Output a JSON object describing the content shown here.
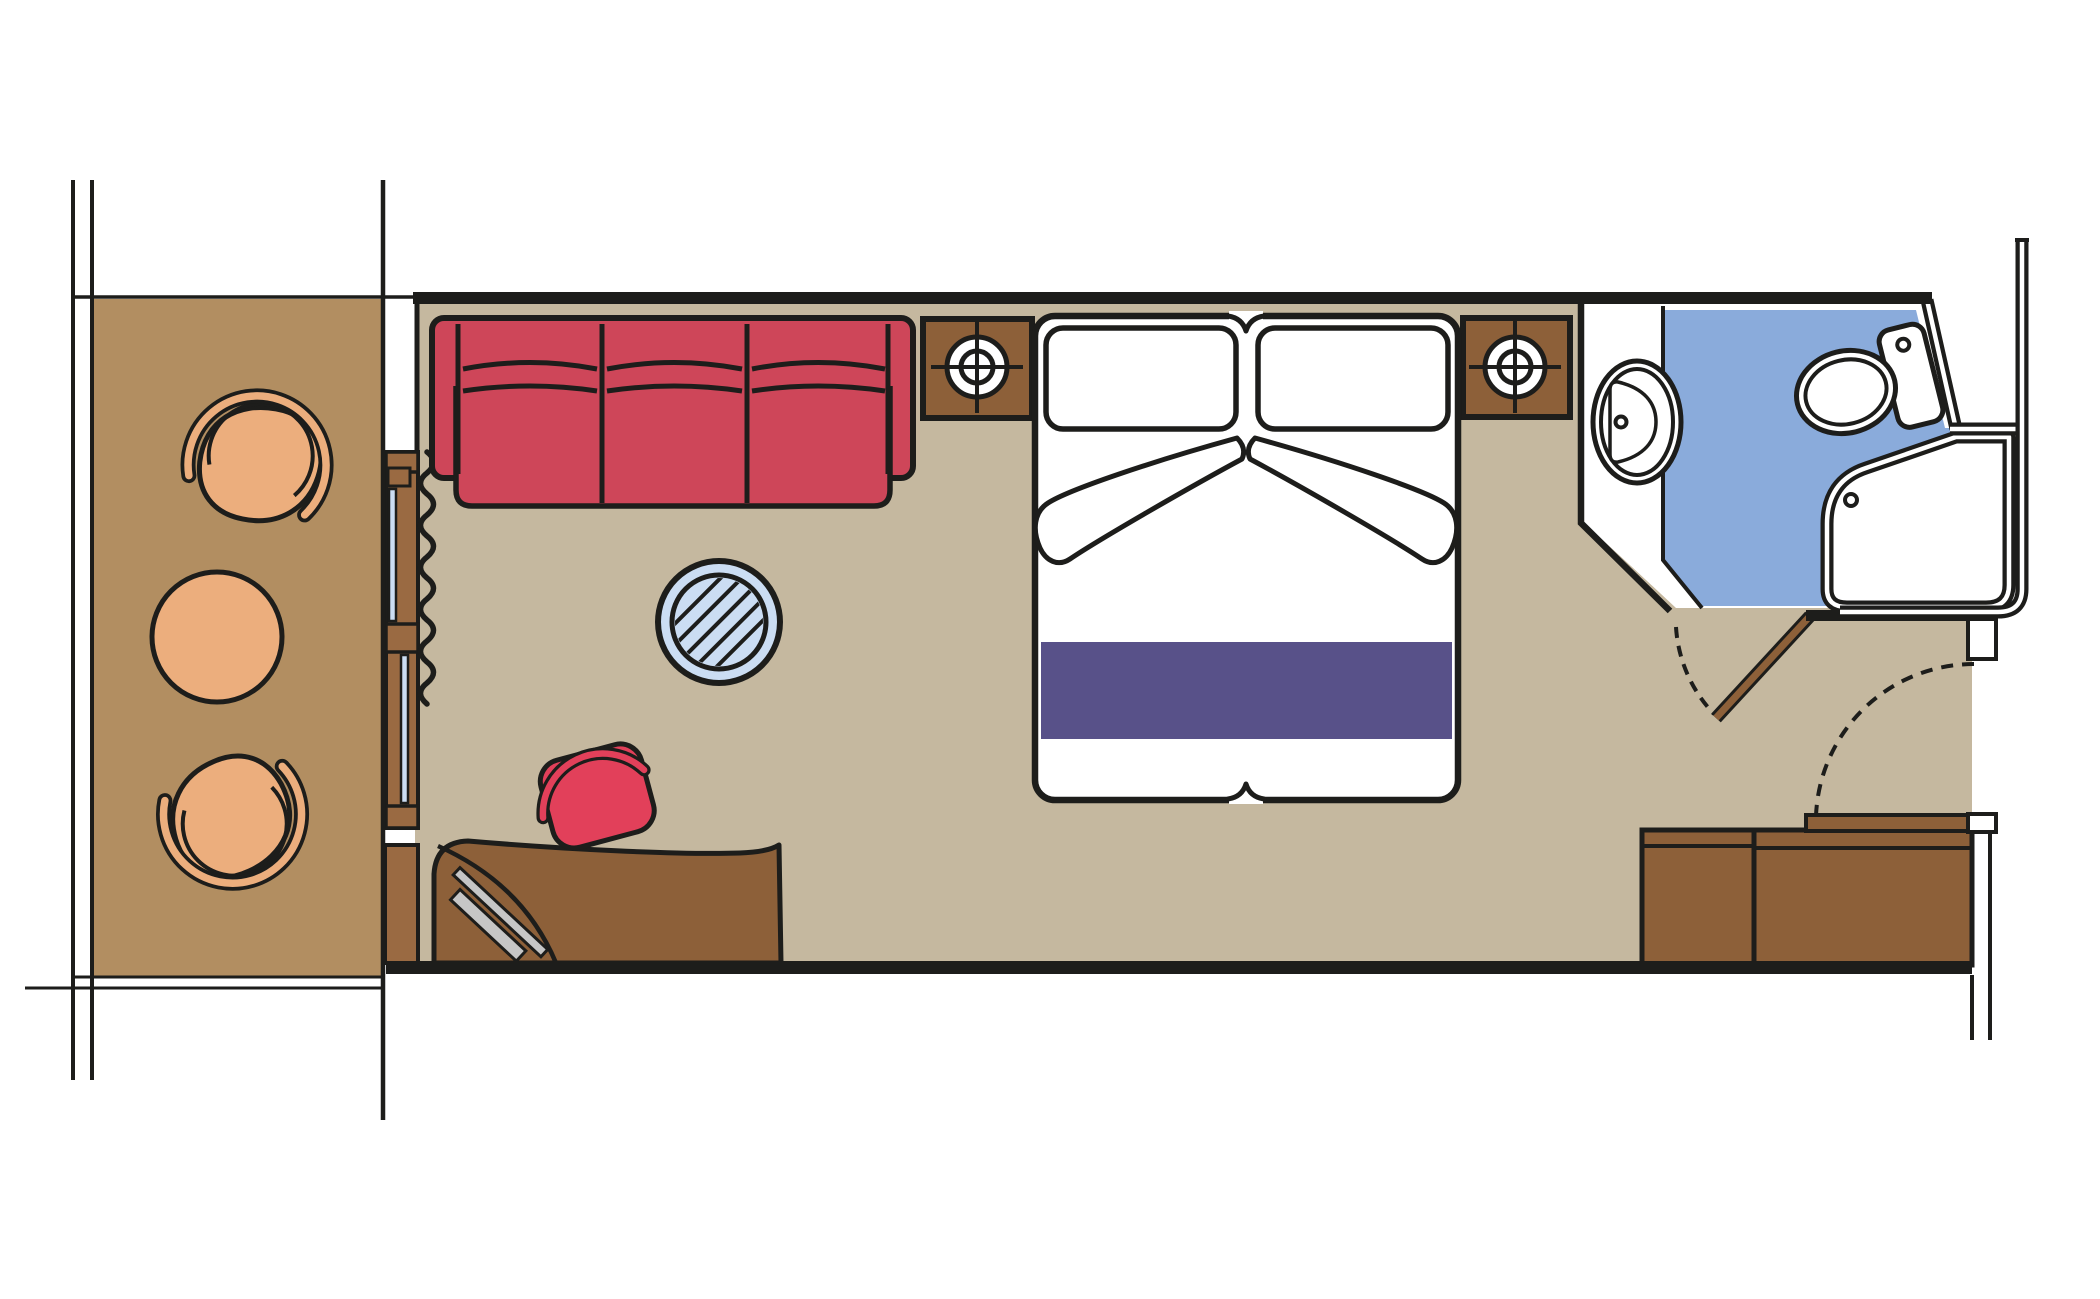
{
  "meta": {
    "title": "Cabin floor plan (top view)",
    "description": "Cruise cabin floor plan with balcony, living/sleeping area, bathroom and entry corridor",
    "text_on_image": "none"
  },
  "palette": {
    "line": "#1d1d1b",
    "deck_wood": "#b28e61",
    "cabin_floor": "#c5b89f",
    "furniture_wood": "#8d6039",
    "slider_wood": "#9a6a42",
    "chair_tan": "#ecae7d",
    "sofa_red": "#ce4659",
    "stool_red": "#e2405a",
    "runner_purple": "#585189",
    "bath_blue": "#8aabdb",
    "glass_blue": "#cbddf3",
    "tv_gray": "#c6c6c6"
  },
  "rooms": [
    {
      "name": "balcony",
      "floor_color_key": "deck_wood",
      "furniture": [
        "deck-chair-top",
        "round-deck-table",
        "deck-chair-bottom"
      ]
    },
    {
      "name": "cabin",
      "floor_color_key": "cabin_floor",
      "furniture": [
        "sliding-glass-door",
        "curtain",
        "sofa-three-seat",
        "nightstand-left-with-lamp",
        "double-bed-with-pillows-and-runner",
        "nightstand-right-with-lamp",
        "round-glass-table",
        "desk",
        "tv-on-desk",
        "stool",
        "wardrobe-two-doors",
        "entry-door-open",
        "entry-door-swing-arc"
      ]
    },
    {
      "name": "bathroom",
      "floor_color_key": "bath_blue",
      "furniture": [
        "vanity-counter",
        "sink-oval",
        "toilet",
        "shower-tray",
        "bathroom-door-open",
        "bathroom-door-swing-arc"
      ]
    },
    {
      "name": "corridor",
      "floor_color_key": "white",
      "furniture": []
    }
  ],
  "bed": {
    "pillows": 2,
    "runner_color_key": "runner_purple"
  },
  "sofa": {
    "seats": 3
  },
  "lamps": {
    "count": 2,
    "symbol": "circle-crosshair"
  }
}
